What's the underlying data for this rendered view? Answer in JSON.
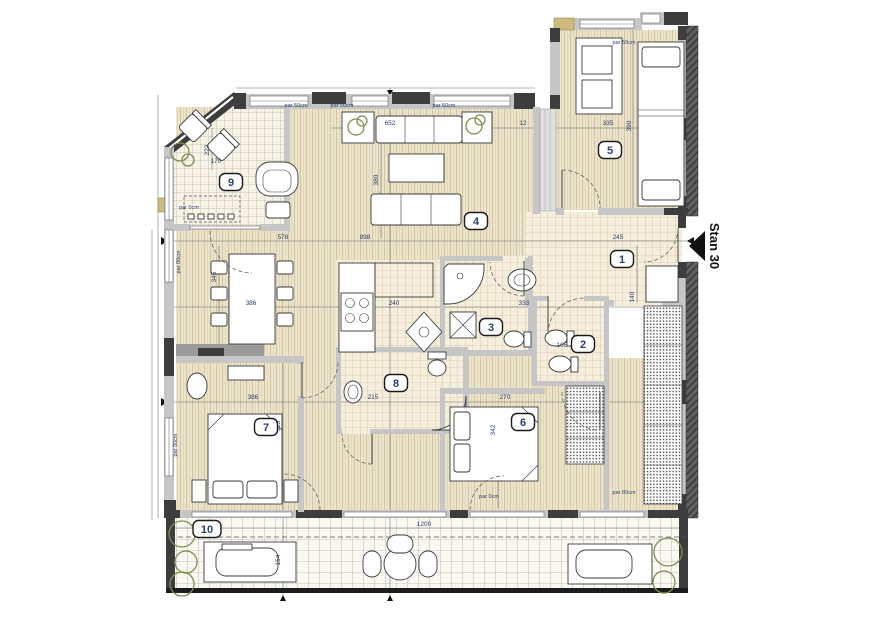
{
  "plan": {
    "apartment_label": "Stan 30",
    "rooms": [
      {
        "number": "1",
        "x": 622,
        "y": 259
      },
      {
        "number": "2",
        "x": 583,
        "y": 344
      },
      {
        "number": "3",
        "x": 491,
        "y": 327
      },
      {
        "number": "4",
        "x": 476,
        "y": 221
      },
      {
        "number": "5",
        "x": 610,
        "y": 150
      },
      {
        "number": "6",
        "x": 523,
        "y": 422
      },
      {
        "number": "7",
        "x": 266,
        "y": 427
      },
      {
        "number": "8",
        "x": 396,
        "y": 383
      },
      {
        "number": "9",
        "x": 231,
        "y": 182
      },
      {
        "number": "10",
        "x": 207,
        "y": 529
      }
    ],
    "dimension_labels": [
      {
        "text": "652",
        "x": 390,
        "y": 125,
        "rot": 0
      },
      {
        "text": "12",
        "x": 523,
        "y": 125,
        "rot": 0
      },
      {
        "text": "335",
        "x": 608,
        "y": 125,
        "rot": 0
      },
      {
        "text": "390",
        "x": 631,
        "y": 126,
        "rot": -90
      },
      {
        "text": "380",
        "x": 378,
        "y": 180,
        "rot": -90
      },
      {
        "text": "222",
        "x": 209,
        "y": 150,
        "rot": -90
      },
      {
        "text": "170",
        "x": 216,
        "y": 163,
        "rot": 0
      },
      {
        "text": "578",
        "x": 283,
        "y": 239,
        "rot": 0
      },
      {
        "text": "898",
        "x": 365,
        "y": 239,
        "rot": 0
      },
      {
        "text": "245",
        "x": 618,
        "y": 239,
        "rot": 0
      },
      {
        "text": "345",
        "x": 216,
        "y": 277,
        "rot": -90
      },
      {
        "text": "386",
        "x": 251,
        "y": 305,
        "rot": 0
      },
      {
        "text": "240",
        "x": 394,
        "y": 305,
        "rot": 0
      },
      {
        "text": "333",
        "x": 524,
        "y": 305,
        "rot": 0
      },
      {
        "text": "140",
        "x": 634,
        "y": 297,
        "rot": -90
      },
      {
        "text": "105",
        "x": 562,
        "y": 347,
        "rot": 0
      },
      {
        "text": "386",
        "x": 253,
        "y": 399,
        "rot": 0
      },
      {
        "text": "215",
        "x": 373,
        "y": 399,
        "rot": 0
      },
      {
        "text": "270",
        "x": 505,
        "y": 399,
        "rot": 0
      },
      {
        "text": "325",
        "x": 280,
        "y": 426,
        "rot": -90
      },
      {
        "text": "342",
        "x": 495,
        "y": 430,
        "rot": -90
      },
      {
        "text": "1200",
        "x": 424,
        "y": 526,
        "rot": 0
      },
      {
        "text": "154",
        "x": 280,
        "y": 560,
        "rot": -90
      }
    ],
    "parapet_labels": [
      {
        "text": "par 50cm",
        "x": 296,
        "y": 107,
        "rot": 0
      },
      {
        "text": "par 50cm",
        "x": 342,
        "y": 107,
        "rot": 0
      },
      {
        "text": "par 50cm",
        "x": 444,
        "y": 107,
        "rot": 0
      },
      {
        "text": "par 50cm",
        "x": 624,
        "y": 44,
        "rot": 0
      },
      {
        "text": "par 0cm",
        "x": 189,
        "y": 209,
        "rot": 0
      },
      {
        "text": "par 80cm",
        "x": 180,
        "y": 262,
        "rot": -90
      },
      {
        "text": "par 80cm",
        "x": 177,
        "y": 445,
        "rot": -90
      },
      {
        "text": "par 80cm",
        "x": 624,
        "y": 494,
        "rot": 0
      },
      {
        "text": "par 0cm",
        "x": 489,
        "y": 498,
        "rot": 0
      }
    ],
    "colors": {
      "wood_floor": "#ece3cb",
      "wood_grain": "#d3c5a2",
      "tile_floor": "#f5eedd",
      "tile_line": "#c9b48b",
      "terrace_floor": "#fbf8f1",
      "terrace_line": "#93908a",
      "wall_light": "#c6c6c6",
      "wall_dark": "#3d3d3d",
      "insulation": "#606060",
      "masonry_tan": "#cdbb7e",
      "plant_green": "#7e8f4f",
      "dimension_text": "#2a3f6f",
      "line_black": "#1c1c1c"
    }
  }
}
